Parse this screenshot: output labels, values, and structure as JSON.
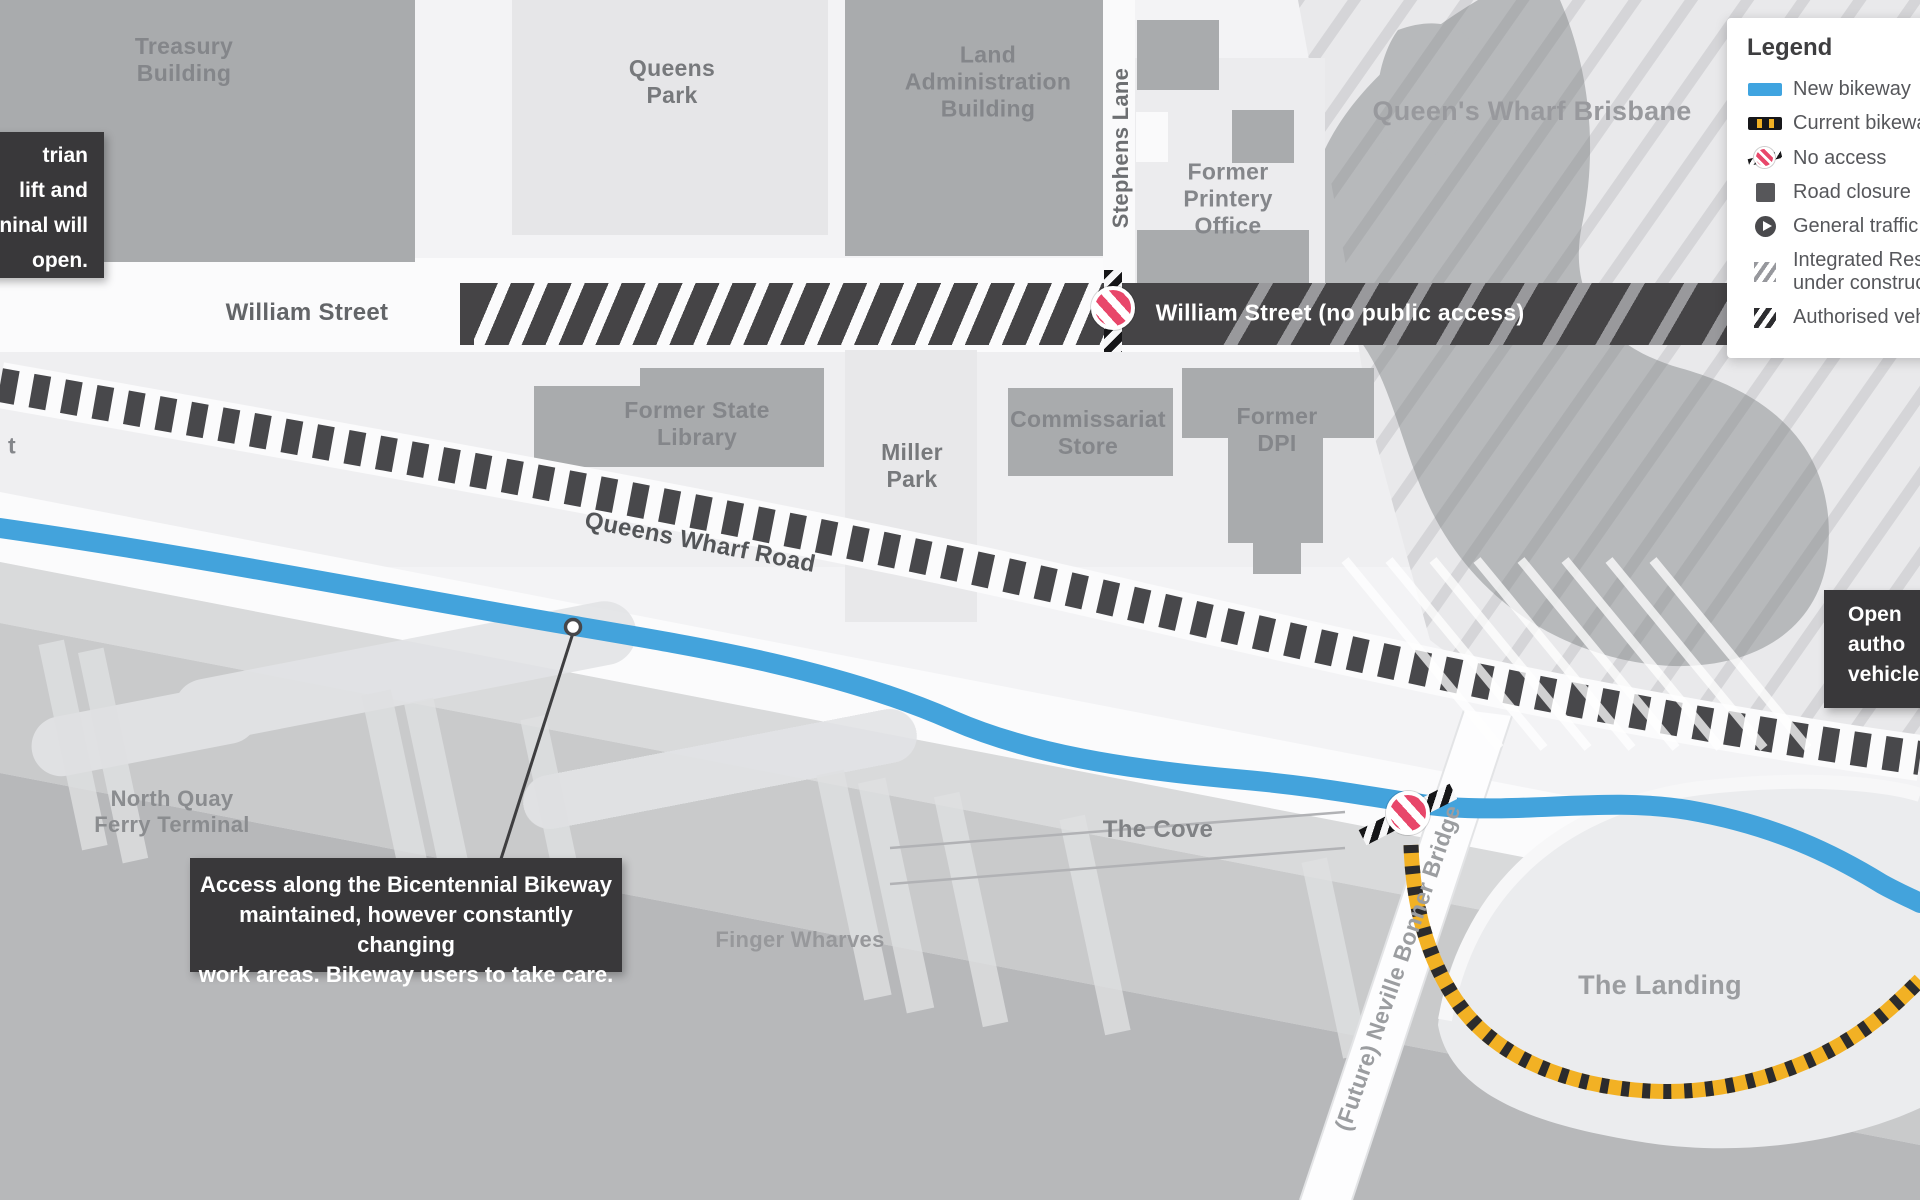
{
  "map": {
    "street_labels": {
      "william_street": "William Street",
      "william_street_closed": "William Street (no public access)",
      "queens_wharf_road": "Queens Wharf Road",
      "stephens_lane": "Stephens Lane",
      "neville_bonner_bridge": "(Future) Neville Bonner Bridge"
    },
    "place_labels": {
      "treasury_building": "Treasury\nBuilding",
      "queens_park": "Queens\nPark",
      "land_administration_building": "Land\nAdministration\nBuilding",
      "former_printery_office": "Former\nPrintery\nOffice",
      "queens_wharf_brisbane": "Queen's Wharf Brisbane",
      "former_state_library": "Former State\nLibrary",
      "miller_park": "Miller\nPark",
      "commissariat_store": "Commissariat\nStore",
      "former_dpi": "Former\nDPI",
      "north_quay_ferry_terminal": "North Quay\nFerry Terminal",
      "the_cove": "The Cove",
      "finger_wharves": "Finger Wharves",
      "the_landing": "The Landing"
    },
    "edge_fragments": {
      "left_street": "t"
    },
    "callouts": {
      "left_partial_lines": [
        "trian",
        "lift and",
        "ninal will",
        "open."
      ],
      "bikeway_note": "Access along the Bicentennial Bikeway\nmaintained, however constantly changing\nwork areas. Bikeway users to take care.",
      "right_partial_lines": [
        "Open",
        "autho",
        "vehicle"
      ]
    }
  },
  "legend": {
    "title": "Legend",
    "items": [
      {
        "icon": "new-bikeway-swatch",
        "label": "New bikeway"
      },
      {
        "icon": "current-bikeway-swatch",
        "label": "Current bikeway"
      },
      {
        "icon": "no-access-icon",
        "label": "No access"
      },
      {
        "icon": "road-closure-swatch",
        "label": "Road closure"
      },
      {
        "icon": "general-traffic-icon",
        "label": "General traffic"
      },
      {
        "icon": "construction-hatch-swatch",
        "label": "Integrated Resort\nunder construction"
      },
      {
        "icon": "authorised-hatch-swatch",
        "label": "Authorised vehicles"
      }
    ]
  },
  "colors": {
    "new_bikeway_blue": "#43a3dc",
    "current_bikeway_yellow": "#f2b124",
    "current_bikeway_black": "#2b2b2d",
    "no_access_red": "#e8476a",
    "road_closure_dark": "#454446",
    "callout_background": "#39383a",
    "building_gray": "#a9abad",
    "water_gray": "#b7b8ba"
  }
}
